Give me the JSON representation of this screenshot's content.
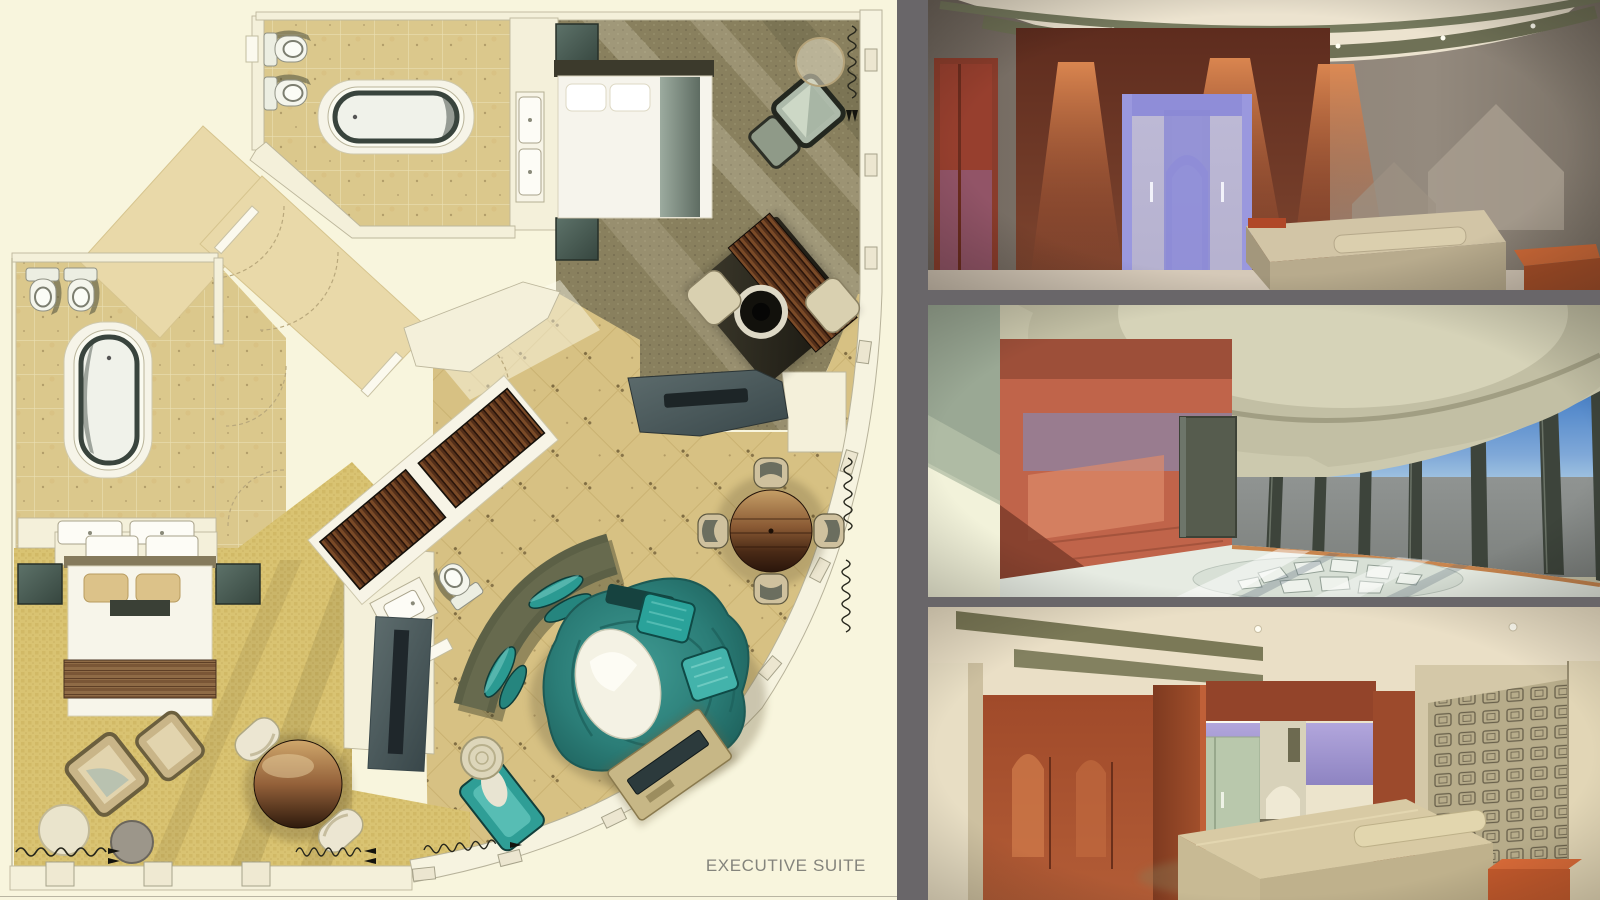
{
  "plan": {
    "label": "EXECUTIVE SUITE",
    "palette": {
      "paper": "#f8f5dd",
      "bath_tile": "#dbc88c",
      "living_tile": "#d7c183",
      "carpet_gold": "#d9c372",
      "carpet_olive": "#89805e",
      "corridor_tan": "#e9d9a9",
      "teal_rug": "#2b7d77",
      "teal_seat": "#2f9e96",
      "dark_wood": "#4a2a16",
      "wall_white": "#f6f3e0"
    },
    "rooms": [
      "master-bathroom",
      "guest-bathroom",
      "master-bedroom",
      "second-bedroom",
      "living-area",
      "entry-corridor",
      "powder-room"
    ],
    "furniture": [
      "bathtub",
      "toilet",
      "bidet",
      "vanity-sink",
      "bed",
      "nightstand",
      "bench",
      "armchair",
      "ottoman",
      "side-table",
      "round-dining-table",
      "dining-chair",
      "desk",
      "curved-sofa",
      "swirl-rug",
      "lounge-cushion",
      "chaise",
      "tv-console",
      "wardrobe-panel",
      "radiator",
      "window-column"
    ]
  },
  "renders": {
    "top": {
      "name": "bedroom-wardrobe-render",
      "palette": [
        "#877a6e",
        "#6e3525",
        "#9a97dc",
        "#cdbf9f",
        "#e9e0cc"
      ]
    },
    "middle": {
      "name": "curved-living-room-render",
      "palette": [
        "#c0644a",
        "#3a74c2",
        "#c9c6ab",
        "#e4eae0",
        "#9aa894"
      ]
    },
    "bottom": {
      "name": "bedroom-corridor-render",
      "palette": [
        "#a84f2c",
        "#a99dd4",
        "#b7ac8a",
        "#cfc2a0",
        "#e9dfc6"
      ]
    }
  }
}
